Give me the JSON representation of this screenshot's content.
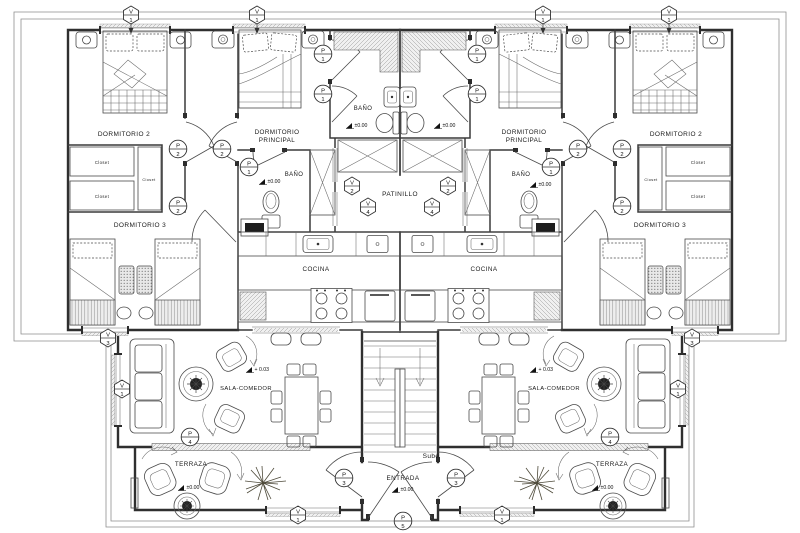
{
  "drawing": {
    "type": "architectural-floor-plan",
    "units": 2,
    "width_px": 800,
    "height_px": 533
  },
  "colors": {
    "wall": "#2f2f2f",
    "line": "#4a4a4a",
    "hatch": "#8a8a8a",
    "text": "#1a1a1a",
    "frame": "#8f8f8f",
    "background": "#ffffff"
  },
  "marker_letters": {
    "window": "V",
    "door": "P"
  },
  "labels": [
    {
      "t": "DORMITORIO 2",
      "x": 124,
      "y": 136,
      "fs": 6.5
    },
    {
      "t": "DORMITORIO",
      "x": 277,
      "y": 134,
      "fs": 6.3
    },
    {
      "t": "PRINCIPAL",
      "x": 277,
      "y": 142,
      "fs": 6.3
    },
    {
      "t": "BAÑO",
      "x": 363,
      "y": 110,
      "fs": 6
    },
    {
      "t": "BAÑO",
      "x": 294,
      "y": 176,
      "fs": 6
    },
    {
      "t": "PATINILLO",
      "x": 400,
      "y": 196,
      "fs": 6.5
    },
    {
      "t": "DORMITORIO 3",
      "x": 140,
      "y": 227,
      "fs": 6.5
    },
    {
      "t": "COCINA",
      "x": 316,
      "y": 271,
      "fs": 6.3
    },
    {
      "t": "SALA-COMEDOR",
      "x": 246,
      "y": 390,
      "fs": 5.8
    },
    {
      "t": "TERRAZA",
      "x": 191,
      "y": 466,
      "fs": 6.3
    },
    {
      "t": "ENTRADA",
      "x": 403,
      "y": 480,
      "fs": 6.3
    },
    {
      "t": "Sube",
      "x": 431,
      "y": 458,
      "fs": 6.5
    },
    {
      "t": "DORMITORIO",
      "x": 524,
      "y": 134,
      "fs": 6.3
    },
    {
      "t": "PRINCIPAL",
      "x": 524,
      "y": 142,
      "fs": 6.3
    },
    {
      "t": "BAÑO",
      "x": 521,
      "y": 176,
      "fs": 6
    },
    {
      "t": "DORMITORIO 2",
      "x": 676,
      "y": 136,
      "fs": 6.5
    },
    {
      "t": "DORMITORIO 3",
      "x": 660,
      "y": 227,
      "fs": 6.5
    },
    {
      "t": "COCINA",
      "x": 484,
      "y": 271,
      "fs": 6.3
    },
    {
      "t": "SALA-COMEDOR",
      "x": 554,
      "y": 390,
      "fs": 5.8
    },
    {
      "t": "TERRAZA",
      "x": 612,
      "y": 466,
      "fs": 6.3
    },
    {
      "t": "Closet",
      "x": 102,
      "y": 164,
      "fs": 4.2,
      "c": "#555555"
    },
    {
      "t": "Closet",
      "x": 102,
      "y": 198,
      "fs": 4.2,
      "c": "#555555"
    },
    {
      "t": "Closet",
      "x": 149,
      "y": 181,
      "fs": 3.8,
      "c": "#555555"
    },
    {
      "t": "Closet",
      "x": 698,
      "y": 164,
      "fs": 4.2,
      "c": "#555555"
    },
    {
      "t": "Closet",
      "x": 698,
      "y": 198,
      "fs": 4.2,
      "c": "#555555"
    },
    {
      "t": "Closet",
      "x": 651,
      "y": 181,
      "fs": 3.8,
      "c": "#555555"
    }
  ],
  "markers": {
    "window": [
      {
        "n": "1",
        "x": 131,
        "y": 15,
        "arrow": true
      },
      {
        "n": "1",
        "x": 257,
        "y": 15,
        "arrow": true
      },
      {
        "n": "1",
        "x": 543,
        "y": 15,
        "arrow": true
      },
      {
        "n": "1",
        "x": 669,
        "y": 15,
        "arrow": true
      },
      {
        "n": "2",
        "x": 352,
        "y": 186
      },
      {
        "n": "2",
        "x": 448,
        "y": 186
      },
      {
        "n": "4",
        "x": 368,
        "y": 207
      },
      {
        "n": "4",
        "x": 432,
        "y": 207
      },
      {
        "n": "3",
        "x": 108,
        "y": 338
      },
      {
        "n": "3",
        "x": 692,
        "y": 338
      },
      {
        "n": "1",
        "x": 122,
        "y": 389
      },
      {
        "n": "1",
        "x": 678,
        "y": 389
      },
      {
        "n": "1",
        "x": 298,
        "y": 515
      },
      {
        "n": "1",
        "x": 502,
        "y": 515
      }
    ],
    "door": [
      {
        "n": "2",
        "x": 178,
        "y": 149
      },
      {
        "n": "2",
        "x": 222,
        "y": 149
      },
      {
        "n": "2",
        "x": 178,
        "y": 206
      },
      {
        "n": "2",
        "x": 578,
        "y": 149
      },
      {
        "n": "2",
        "x": 622,
        "y": 149
      },
      {
        "n": "2",
        "x": 622,
        "y": 206
      },
      {
        "n": "1",
        "x": 323,
        "y": 54
      },
      {
        "n": "1",
        "x": 323,
        "y": 94
      },
      {
        "n": "1",
        "x": 477,
        "y": 54
      },
      {
        "n": "1",
        "x": 477,
        "y": 94
      },
      {
        "n": "1",
        "x": 249,
        "y": 167
      },
      {
        "n": "1",
        "x": 551,
        "y": 167
      },
      {
        "n": "3",
        "x": 344,
        "y": 478
      },
      {
        "n": "3",
        "x": 456,
        "y": 478
      },
      {
        "n": "4",
        "x": 190,
        "y": 437
      },
      {
        "n": "4",
        "x": 610,
        "y": 437
      },
      {
        "n": "5",
        "x": 403,
        "y": 521
      }
    ]
  },
  "elevations": [
    {
      "t": "±0.00",
      "x": 352,
      "y": 127
    },
    {
      "t": "±0.00",
      "x": 440,
      "y": 127
    },
    {
      "t": "±0.00",
      "x": 265,
      "y": 183
    },
    {
      "t": "±0.00",
      "x": 536,
      "y": 186
    },
    {
      "t": "+ 0.03",
      "x": 252,
      "y": 371
    },
    {
      "t": "+ 0.03",
      "x": 536,
      "y": 371
    },
    {
      "t": "±0.00",
      "x": 184,
      "y": 489
    },
    {
      "t": "±0.00",
      "x": 598,
      "y": 489
    },
    {
      "t": "±0.00",
      "x": 398,
      "y": 491
    }
  ]
}
